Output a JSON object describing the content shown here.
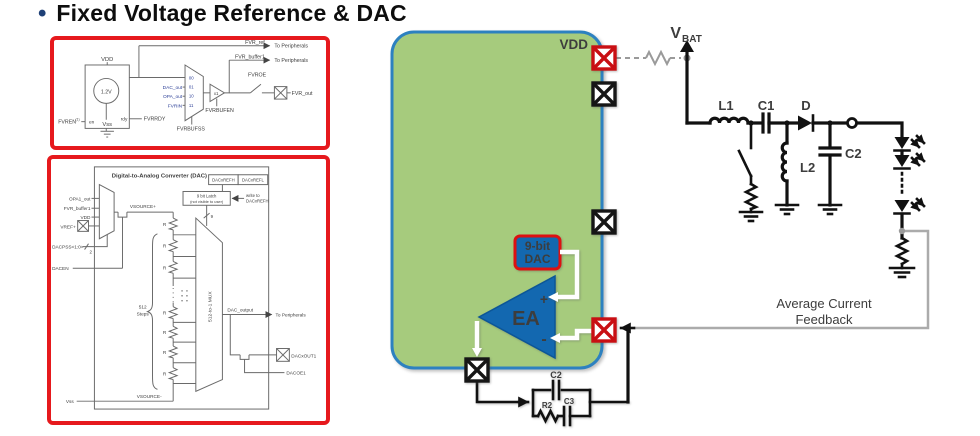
{
  "slide": {
    "bullet": "•",
    "title": "Fixed Voltage Reference & DAC"
  },
  "colors": {
    "frame_red": "#e6191d",
    "mcu_fill": "#a6cb7d",
    "mcu_border": "#2d81c0",
    "block_blue": "#1368b0",
    "block_red_outline": "#dd1111",
    "pin_red": "#c90f13",
    "pin_black": "#161616",
    "feedback_gray": "#ababab",
    "scan_blue_text": "#2c3f97"
  },
  "fvr": {
    "vdd": "VDD",
    "vss": "Vss",
    "ref": "1.2V",
    "fvren": "FVREN",
    "fvren_note": "(1)",
    "en": "en",
    "rdy": "rdy",
    "fvrrdy": "FVRRDY",
    "slots": [
      "00",
      "01",
      "10",
      "11"
    ],
    "dac_out": "DAC_out",
    "opa_out": "OPA_out",
    "fvrin": "FVRIN",
    "fvrbufss": "FVRBUFSS",
    "gain": "x1",
    "fvrbufen": "FVRBUFEN",
    "fvr_ref": "FVR_ref",
    "fvr_buffer1": "FVR_buffer1",
    "to_peripherals": "To Peripherals",
    "fvroe": "FVROE",
    "fvr_out": "FVR_out"
  },
  "dac": {
    "title": "Digital-to-Analog Converter (DAC)",
    "refh": "DACxREFH",
    "refl": "DACxREFL",
    "latch1": "9 bit Latch",
    "latch2": "(not visible to user)",
    "write1": "write to",
    "write2": "DACxREFH",
    "opa1_out": "OPA1_out",
    "fvr_buffer1": "FVR_buffer1",
    "vdd": "VDD",
    "vref": "VREF+",
    "dacpss": "DACPSS<1:0>",
    "bus2": "2",
    "dacen": "DACEN",
    "vsrc_p": "VSOURCE+",
    "vsrc_m": "VSOURCE-",
    "vss": "Vss",
    "r": "R",
    "steps1": "512",
    "steps2": "Steps",
    "bus9": "9",
    "mux": "512-to-1 MUX",
    "dac_output": "DAC_output",
    "to_peripherals": "To Peripherals",
    "dacxout1": "DACxOUT1",
    "dacoe1": "DACOE1"
  },
  "circuit": {
    "vdd": "VDD",
    "vbat_v": "V",
    "vbat_sub": "BAT",
    "l1": "L1",
    "c1": "C1",
    "d": "D",
    "l2": "L2",
    "c2": "C2",
    "dac1": "9-bit",
    "dac2": "DAC",
    "ea": "EA",
    "plus": "+",
    "minus": "-",
    "fb1": "Average Current",
    "fb2": "Feedback",
    "comp_c2": "C2",
    "comp_r2": "R2",
    "comp_c3": "C3"
  }
}
